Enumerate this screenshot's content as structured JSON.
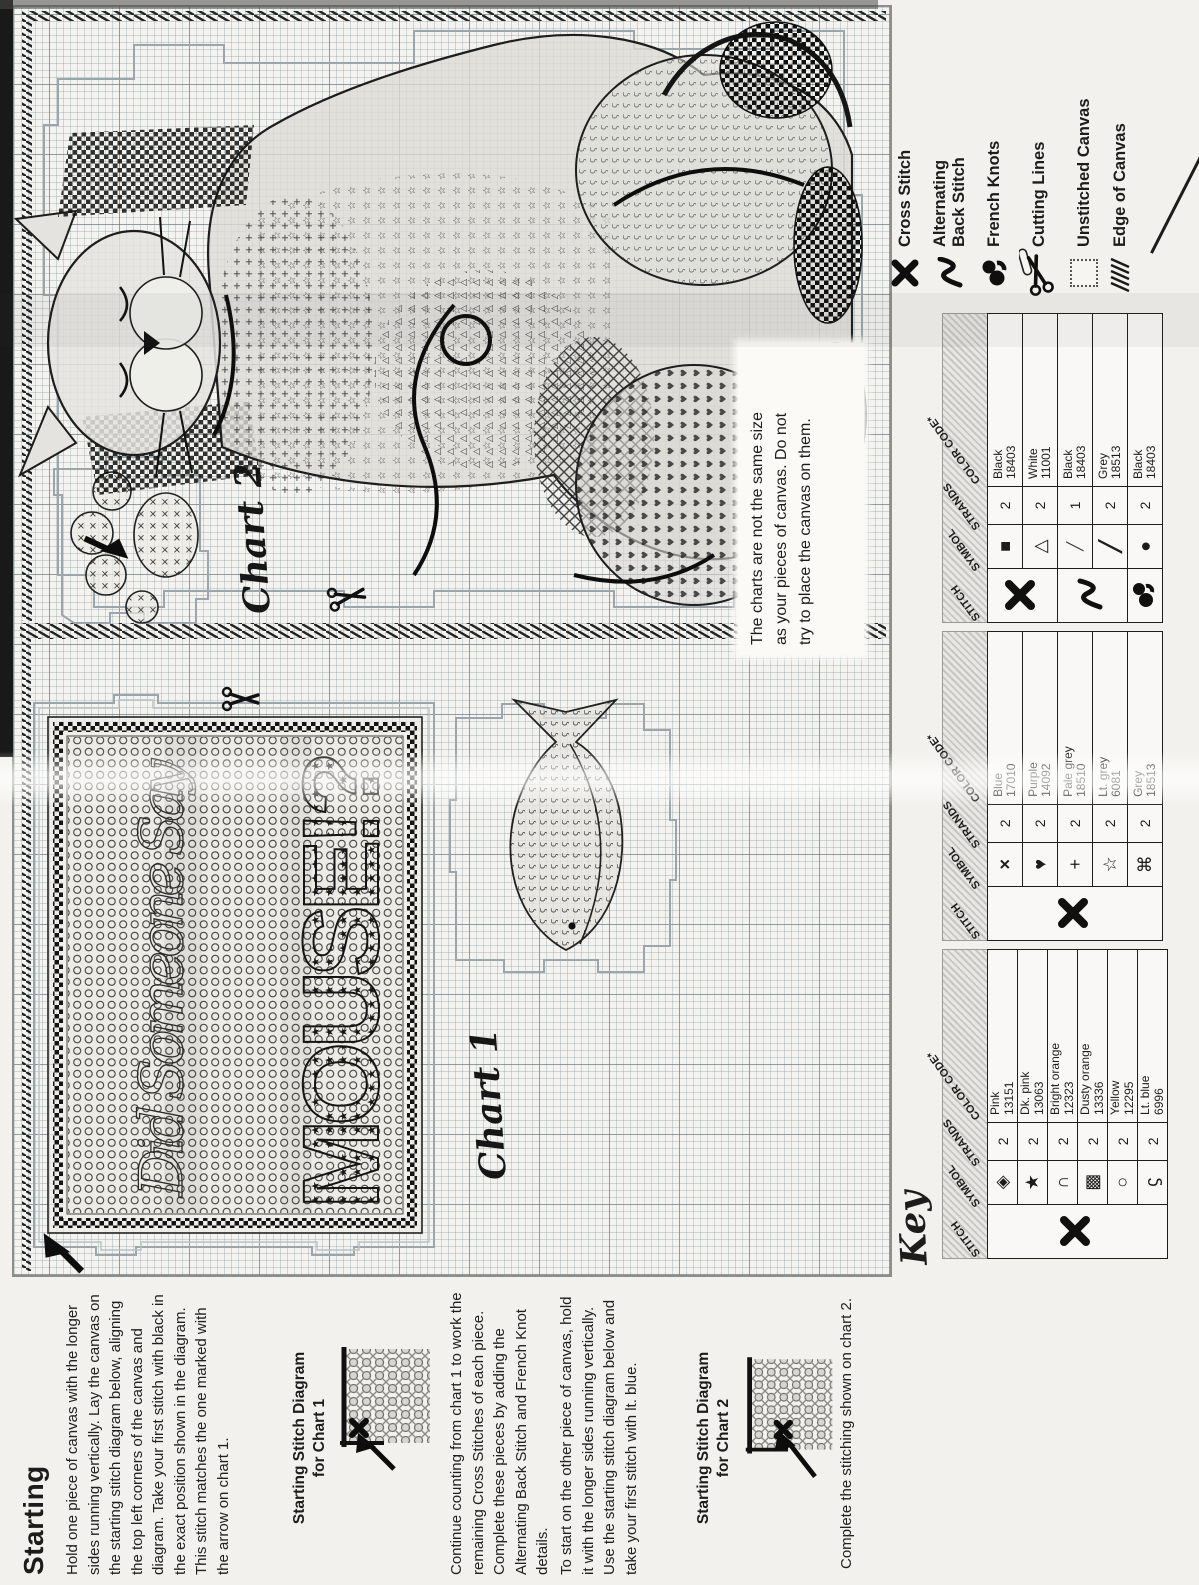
{
  "instructions": {
    "heading": "Starting",
    "p1": "Hold one piece of canvas with the longer sides running vertically. Lay the canvas on the starting stitch diagram below, aligning the top left corners of the canvas and diagram. Take your first stitch with black in the exact position shown in the diagram. This stitch matches the one marked with the arrow on chart 1.",
    "diagram1_title_l1": "Starting Stitch Diagram",
    "diagram1_title_l2": "for Chart 1",
    "p2": "Continue counting from chart 1 to work the remaining Cross Stitches of each piece. Complete these pieces by adding the Alternating Back Stitch and French Knot details.",
    "p3": "To start on the other piece of canvas, hold it with the longer sides running vertically. Use the starting stitch diagram below and take your first stitch with lt. blue.",
    "diagram2_title_l1": "Starting Stitch Diagram",
    "diagram2_title_l2": "for Chart 2",
    "p4": "Complete the stitching shown on chart 2."
  },
  "chart1": {
    "label": "Chart 1",
    "sampler_script": "Did Someone Say",
    "sampler_word": "MOUSE!?",
    "note_l1": "The charts are not the same size",
    "note_l2": "as your pieces of canvas. Do not",
    "note_l3": "try to place the canvas on them."
  },
  "chart2": {
    "label": "Chart 2"
  },
  "key": {
    "label": "Key",
    "headers": [
      "STITCH",
      "SYMBOL",
      "STRANDS",
      "COLOR CODE*"
    ],
    "tables": [
      {
        "stitch": "cross-stitch",
        "rows": [
          {
            "symbol": "◈",
            "strands": "2",
            "color": "Pink",
            "code": "13151"
          },
          {
            "symbol": "★",
            "strands": "2",
            "color": "Dk. pink",
            "code": "13063"
          },
          {
            "symbol": "∩",
            "strands": "2",
            "color": "Bright orange",
            "code": "12323"
          },
          {
            "symbol": "▩",
            "strands": "2",
            "color": "Dusty orange",
            "code": "13336"
          },
          {
            "symbol": "○",
            "strands": "2",
            "color": "Yellow",
            "code": "12295"
          },
          {
            "symbol": "ϛ",
            "strands": "2",
            "color": "Lt. blue",
            "code": "6996"
          }
        ]
      },
      {
        "stitch": "cross-stitch",
        "rows": [
          {
            "symbol": "×",
            "strands": "2",
            "color": "Blue",
            "code": "17010"
          },
          {
            "symbol": "♥",
            "strands": "2",
            "color": "Purple",
            "code": "14092"
          },
          {
            "symbol": "+",
            "strands": "2",
            "color": "Pale grey",
            "code": "18510"
          },
          {
            "symbol": "☆",
            "strands": "2",
            "color": "Lt. grey",
            "code": "6081"
          },
          {
            "symbol": "⌘",
            "strands": "2",
            "color": "Grey",
            "code": "18513"
          }
        ]
      },
      {
        "stitch": "cross-stitch / back-stitch / french-knots",
        "rows": [
          {
            "symbol": "■",
            "strands": "2",
            "color": "Black",
            "code": "18403"
          },
          {
            "symbol": "△",
            "strands": "2",
            "color": "White",
            "code": "11001"
          },
          {
            "symbol": "╱",
            "strands": "1",
            "color": "Black",
            "code": "18403"
          },
          {
            "symbol": "╱",
            "strands": "2",
            "color": "Grey",
            "code": "18513"
          },
          {
            "symbol": "●",
            "strands": "2",
            "color": "Black",
            "code": "18403"
          }
        ]
      }
    ],
    "legend": [
      {
        "label": "Cross Stitch"
      },
      {
        "label_l1": "Alternating",
        "label_l2": "Back Stitch"
      },
      {
        "label": "French Knots"
      },
      {
        "label": "Cutting Lines"
      },
      {
        "label": "Unstitched Canvas"
      },
      {
        "label": "Edge of Canvas"
      }
    ]
  },
  "colors": {
    "paper": "#f2f1ed",
    "ink": "#1c1c1c",
    "grid_minor": "#aebcc2",
    "grid_major": "#62787f",
    "cutting_line": "#9aa6ab",
    "shade_grey": "#d9d8d4"
  }
}
